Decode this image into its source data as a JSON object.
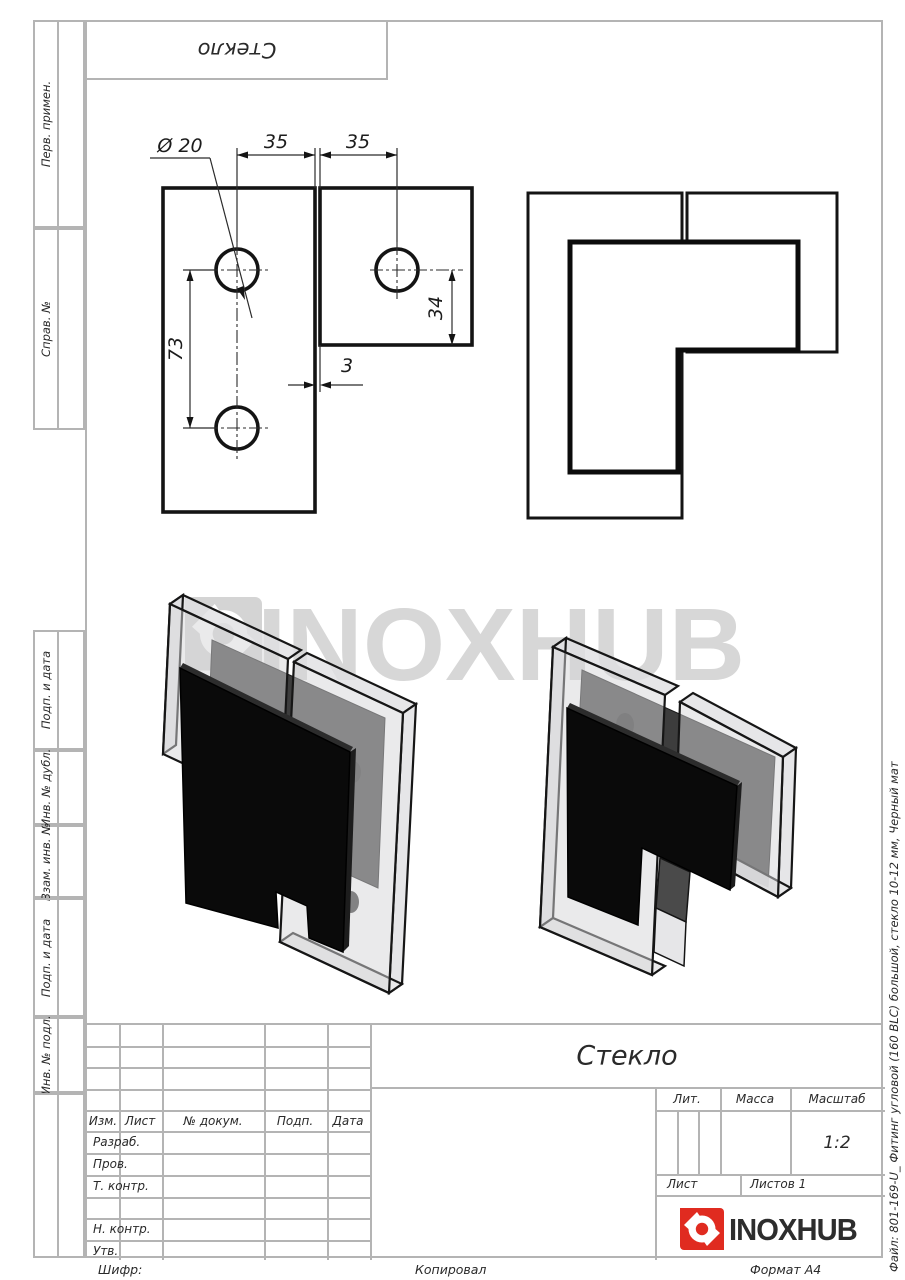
{
  "colors": {
    "brand_red": "#e02b20",
    "drawing_line": "#141414",
    "form_line": "#b4b4b4",
    "watermark_gray": "#d7d7d7"
  },
  "top_stamp": {
    "label": "Стекло"
  },
  "sidebar": {
    "blocks": [
      {
        "label": "Перв. примен."
      },
      {
        "label": "Справ. №"
      },
      {
        "label": "Подп. и дата"
      },
      {
        "label": "Инв. № дубл."
      },
      {
        "label": "Взам. инв. №"
      },
      {
        "label": "Подп. и дата"
      },
      {
        "label": "Инв. № подл."
      }
    ]
  },
  "front_view": {
    "dims": {
      "diameter": "Ø 20",
      "width_left": "35",
      "width_right": "35",
      "height_left": "73",
      "height_right": "34",
      "gap": "3"
    }
  },
  "watermark": {
    "text": "INOXHUB"
  },
  "title_block": {
    "title": "Стекло",
    "columns": {
      "izm": "Изм.",
      "list": "Лист",
      "num_dokum": "№ докум.",
      "podp": "Подп.",
      "data": "Дата"
    },
    "rows": {
      "razrab": "Разраб.",
      "prov": "Пров.",
      "t_kontr": "Т. контр.",
      "n_kontr": "Н. контр.",
      "utv": "Утв."
    },
    "lit": "Лит.",
    "massa": "Масса",
    "masshtab": "Масштаб",
    "scale": "1:2",
    "list_label": "Лист",
    "listov_label": "Листов 1",
    "brand": "INOXHUB"
  },
  "footer": {
    "shifr": "Шифр:",
    "kopiroval": "Копировал",
    "format": "Формат А4"
  },
  "side_note": "Файл: 801-169-U_ Фитинг угловой (160 BLC) большой, стекло 10-12 мм, Черный мат"
}
